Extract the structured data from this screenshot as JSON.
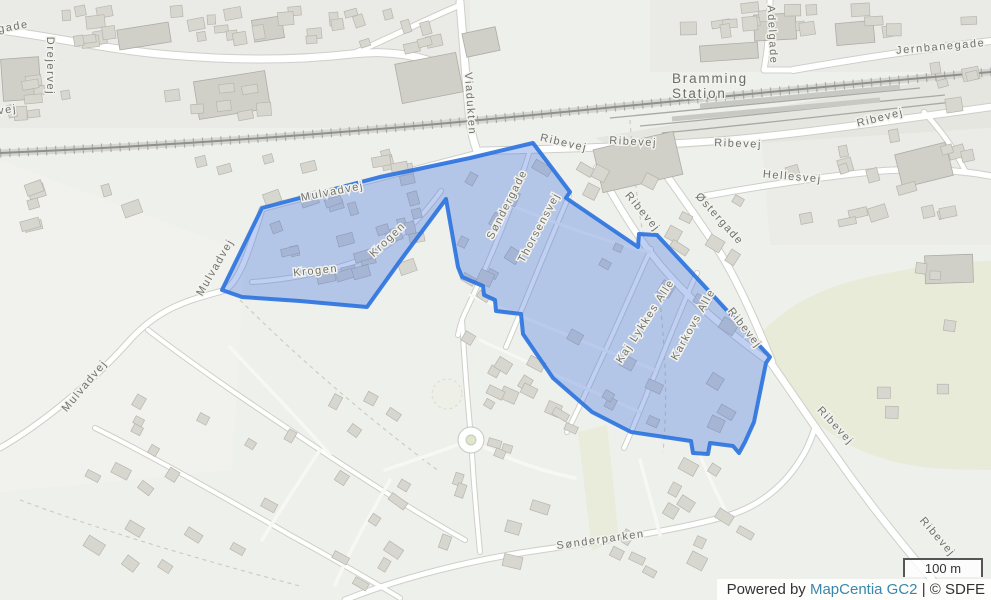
{
  "map": {
    "street_labels": [
      {
        "text": "gade",
        "x": 14,
        "y": 30,
        "r": -10
      },
      {
        "text": "vej",
        "x": 8,
        "y": 113,
        "r": -8
      },
      {
        "text": "Drejervej",
        "x": 47,
        "y": 66,
        "r": 90
      },
      {
        "text": "Viadukten",
        "x": 467,
        "y": 104,
        "r": 86
      },
      {
        "text": "Jernbanegade",
        "x": 941,
        "y": 50,
        "r": -5
      },
      {
        "text": "Adelgade",
        "x": 769,
        "y": 35,
        "r": 87
      },
      {
        "text": "Ribevej",
        "x": 563,
        "y": 146,
        "r": 13
      },
      {
        "text": "Ribevej",
        "x": 633,
        "y": 145,
        "r": 3
      },
      {
        "text": "Ribevej",
        "x": 738,
        "y": 147,
        "r": 2
      },
      {
        "text": "Ribevej",
        "x": 881,
        "y": 121,
        "r": -14
      },
      {
        "text": "Hellesvej",
        "x": 792,
        "y": 180,
        "r": 5
      },
      {
        "text": "Ribevej",
        "x": 640,
        "y": 214,
        "r": 50
      },
      {
        "text": "Østergade",
        "x": 717,
        "y": 221,
        "r": 48
      },
      {
        "text": "Ribevej",
        "x": 742,
        "y": 330,
        "r": 52
      },
      {
        "text": "Ribevej",
        "x": 833,
        "y": 428,
        "r": 47
      },
      {
        "text": "Ribevej",
        "x": 935,
        "y": 539,
        "r": 49
      },
      {
        "text": "Mulvadvej",
        "x": 333,
        "y": 195,
        "r": -11
      },
      {
        "text": "Mulvadvej",
        "x": 218,
        "y": 269,
        "r": -60
      },
      {
        "text": "Mulvadvej",
        "x": 87,
        "y": 388,
        "r": -50
      },
      {
        "text": "Krogen",
        "x": 390,
        "y": 242,
        "r": -44
      },
      {
        "text": "Krogen",
        "x": 316,
        "y": 274,
        "r": -6
      },
      {
        "text": "Søndergade",
        "x": 510,
        "y": 206,
        "r": -63
      },
      {
        "text": "Thorsensvej",
        "x": 542,
        "y": 229,
        "r": -62
      },
      {
        "text": "Kaj Lykkes Alle",
        "x": 648,
        "y": 323,
        "r": -57
      },
      {
        "text": "Karkovs Alle",
        "x": 696,
        "y": 326,
        "r": -61
      },
      {
        "text": "Sønderparken",
        "x": 601,
        "y": 543,
        "r": -8
      }
    ],
    "place_labels": [
      {
        "text": "Bramming",
        "x": 672,
        "y": 83
      },
      {
        "text": "Station",
        "x": 672,
        "y": 98
      }
    ],
    "scale_bar": {
      "label": "100 m"
    },
    "attribution": {
      "prefix": "Powered by ",
      "link_text": "MapCentia GC2",
      "suffix": " | © SDFE"
    },
    "colors": {
      "selection_stroke": "#2e74e0",
      "selection_fill": "#3c6edc",
      "link": "#3a87ad",
      "label": "#72726b"
    }
  }
}
